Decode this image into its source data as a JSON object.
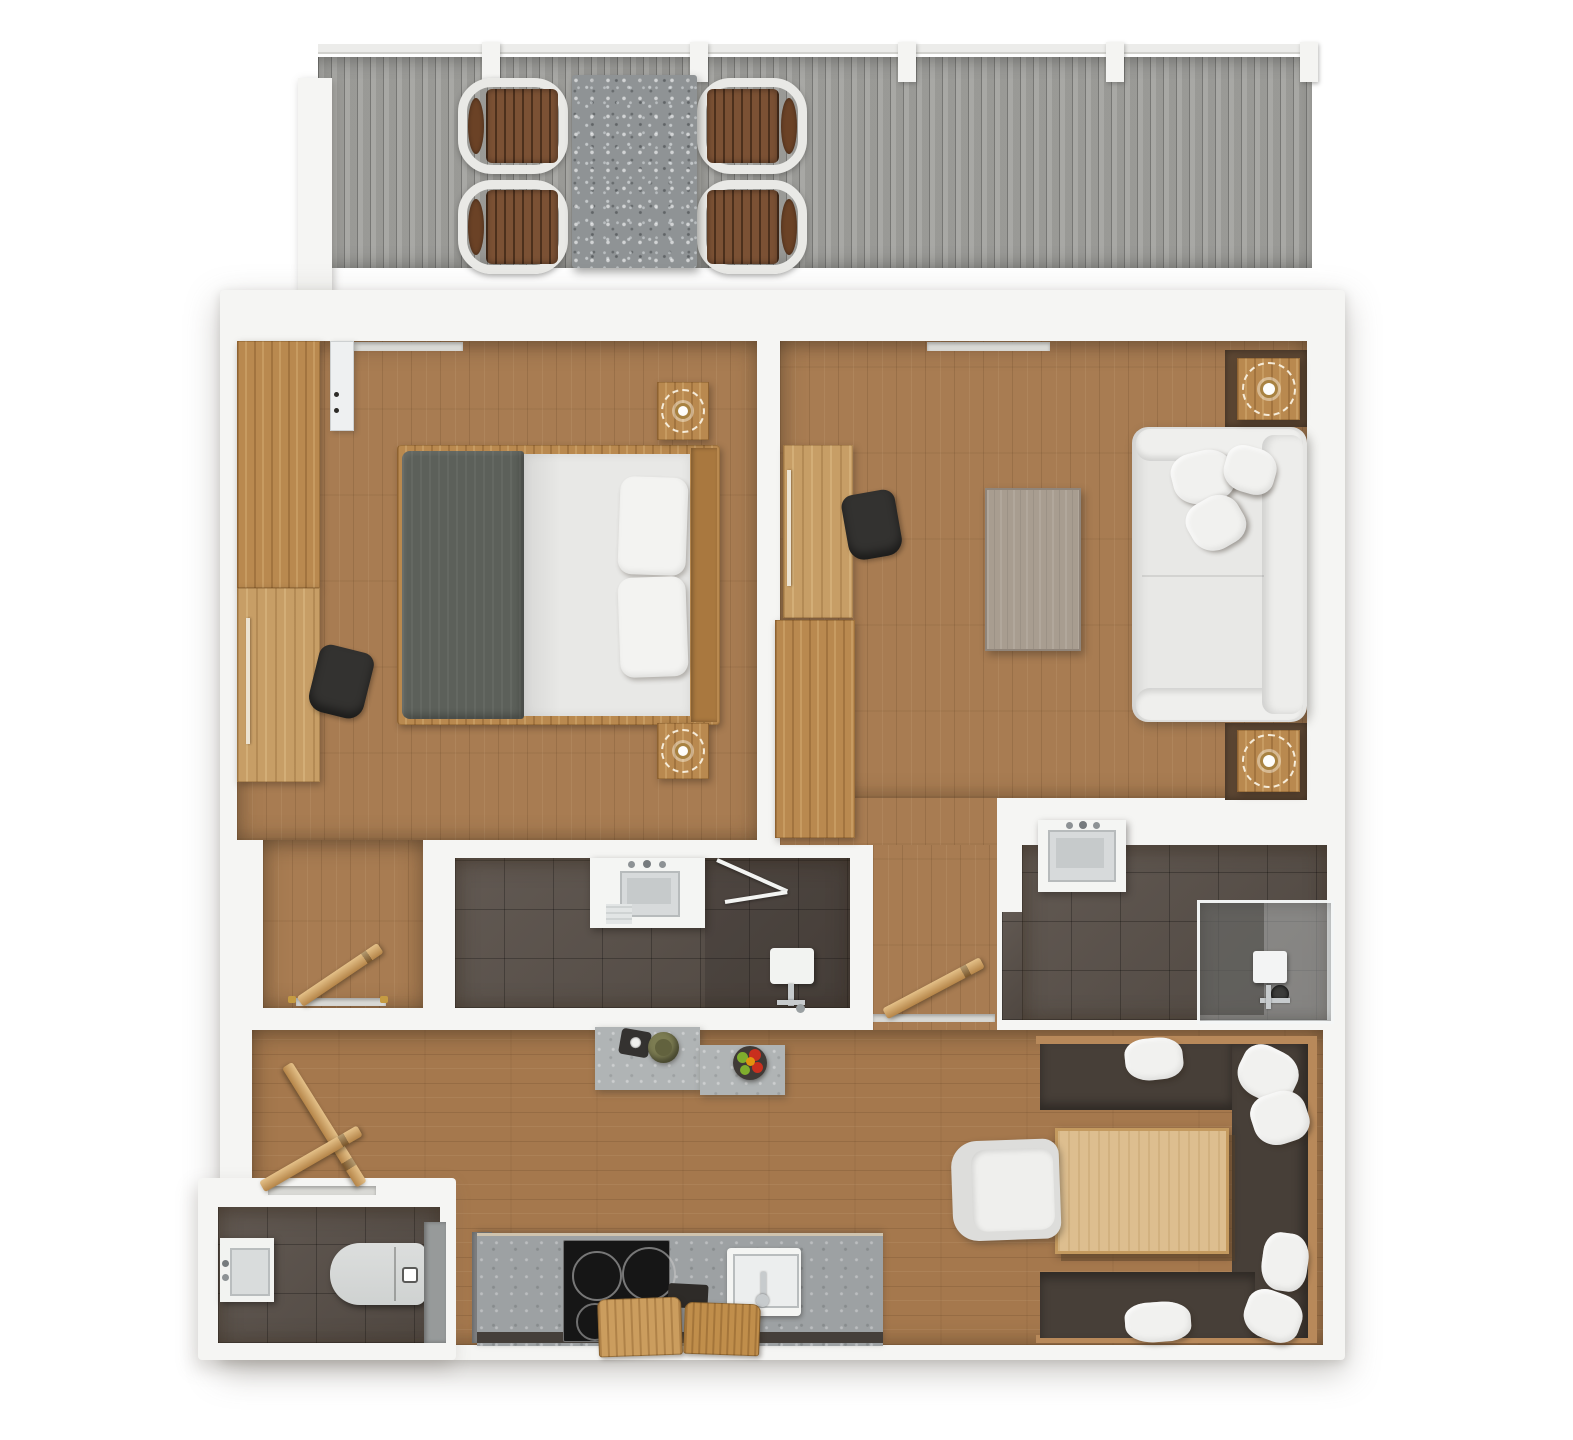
{
  "image": {
    "type": "3d-floor-plan-render",
    "view": "top-down",
    "width_px": 1573,
    "height_px": 1440
  },
  "palette": {
    "bg": "#ffffff",
    "wall": "#f5f5f3",
    "deck": "#a3a39f",
    "stone": "#8f9395",
    "counter-stone": "#9da1a3",
    "island-stone": "#b0b4b5",
    "wood-floor": "#a87c52",
    "wood-floor-warm": "#a5784d",
    "tile": "#584f48",
    "oak": "#b9894f",
    "oak-light": "#c79e66",
    "walnut": "#5d4733",
    "beech": "#ddbe8f",
    "duvet": "#5c605a",
    "bench": "#473f38",
    "soft-white": "#e8e8e6",
    "pillow": "#f1f1ef",
    "dark-chair": "#333230",
    "chrome": "#c7cbcd",
    "cooktop": "#161616",
    "brass": "#c59b42",
    "olive": "#7c7c52",
    "fruit-red": "#c92f1e",
    "fruit-green": "#7fae2d",
    "fruit-orange": "#e2930f"
  },
  "rooms": [
    {
      "id": "balcony",
      "name": "balcony-terrace",
      "furniture": [
        "stone outdoor dining table",
        "4 wood-slat outdoor chairs",
        "grey wood decking",
        "railing with posts"
      ]
    },
    {
      "id": "bedroom",
      "name": "bedroom",
      "furniture": [
        "double bed with grey duvet and 2 pillows",
        "headboard",
        "2 nightstands with rattan lamps",
        "wardrobe",
        "dresser-desk with handle",
        "dark desk chair",
        "wall mirror"
      ]
    },
    {
      "id": "living-room",
      "name": "living-room",
      "furniture": [
        "white sofa with 3 cushions",
        "coffee table",
        "desk with handle",
        "dark desk chair",
        "sideboard",
        "2 side tables with rattan lamps on walnut mats"
      ]
    },
    {
      "id": "bathroom-main",
      "name": "bathroom-1-center",
      "furniture": [
        "washbasin unit",
        "folding glass shower screen",
        "wall-hung toilet with chrome fittings",
        "dark tile floor"
      ]
    },
    {
      "id": "bathroom-ensuite",
      "name": "bathroom-2-right",
      "furniture": [
        "washbasin unit",
        "glass shower enclosure with seat and shower head",
        "dark tile floor"
      ]
    },
    {
      "id": "hallway",
      "name": "entrance-hall-and-corridor",
      "furniture": [
        "3 open wooden door leaves",
        "door thresholds",
        "brass door stops"
      ]
    },
    {
      "id": "kitchen",
      "name": "kitchen",
      "furniture": [
        "stone counter",
        "induction cooktop with 4 burners",
        "white sink with faucet",
        "2 cutting boards",
        "dark tray",
        "tall unit",
        "stone island with serving board, olive bowl and fruit bowl"
      ]
    },
    {
      "id": "dining",
      "name": "dining-nook",
      "furniture": [
        "U-shaped dark bench with wood rim",
        "6 white cushions",
        "beech dining table",
        "white armchair"
      ]
    },
    {
      "id": "wc",
      "name": "guest-wc",
      "furniture": [
        "washbasin",
        "toilet",
        "tall grey cabinet",
        "dark tile floor"
      ]
    }
  ]
}
